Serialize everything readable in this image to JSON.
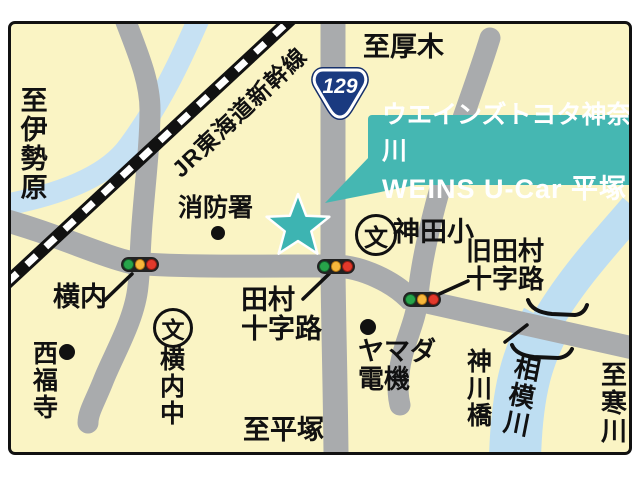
{
  "map": {
    "railway_label": "JR東海道新幹線",
    "route_shield": {
      "number": "129"
    },
    "callout": {
      "line1": "ウエインズトヨタ神奈川",
      "line2": "WEINS U-Car 平塚"
    },
    "directions": {
      "north": "至厚木",
      "west": "至伊勢原",
      "south": "至平塚",
      "east": "至寒川"
    },
    "school_symbol": "文",
    "landmarks": {
      "fire_station": "消防署",
      "kanda_elementary": "神田小",
      "yokouchi_junior_high": "横内中",
      "saifukuji_temple": "西福寺",
      "yamada_denki": {
        "line1": "ヤマダ",
        "line2": "電機"
      }
    },
    "intersections": {
      "yokouchi": "横内",
      "tamura": {
        "line1": "田村",
        "line2": "十字路"
      },
      "kyu_tamura": {
        "line1": "旧田村",
        "line2": "十字路"
      }
    },
    "river": "相模川",
    "bridge": "神川橋",
    "colors": {
      "background": "#faf4c4",
      "road": "#a9abad",
      "river": "#bedef2",
      "accent_teal": "#45b7b2",
      "shield_navy": "#1a3a80"
    }
  }
}
